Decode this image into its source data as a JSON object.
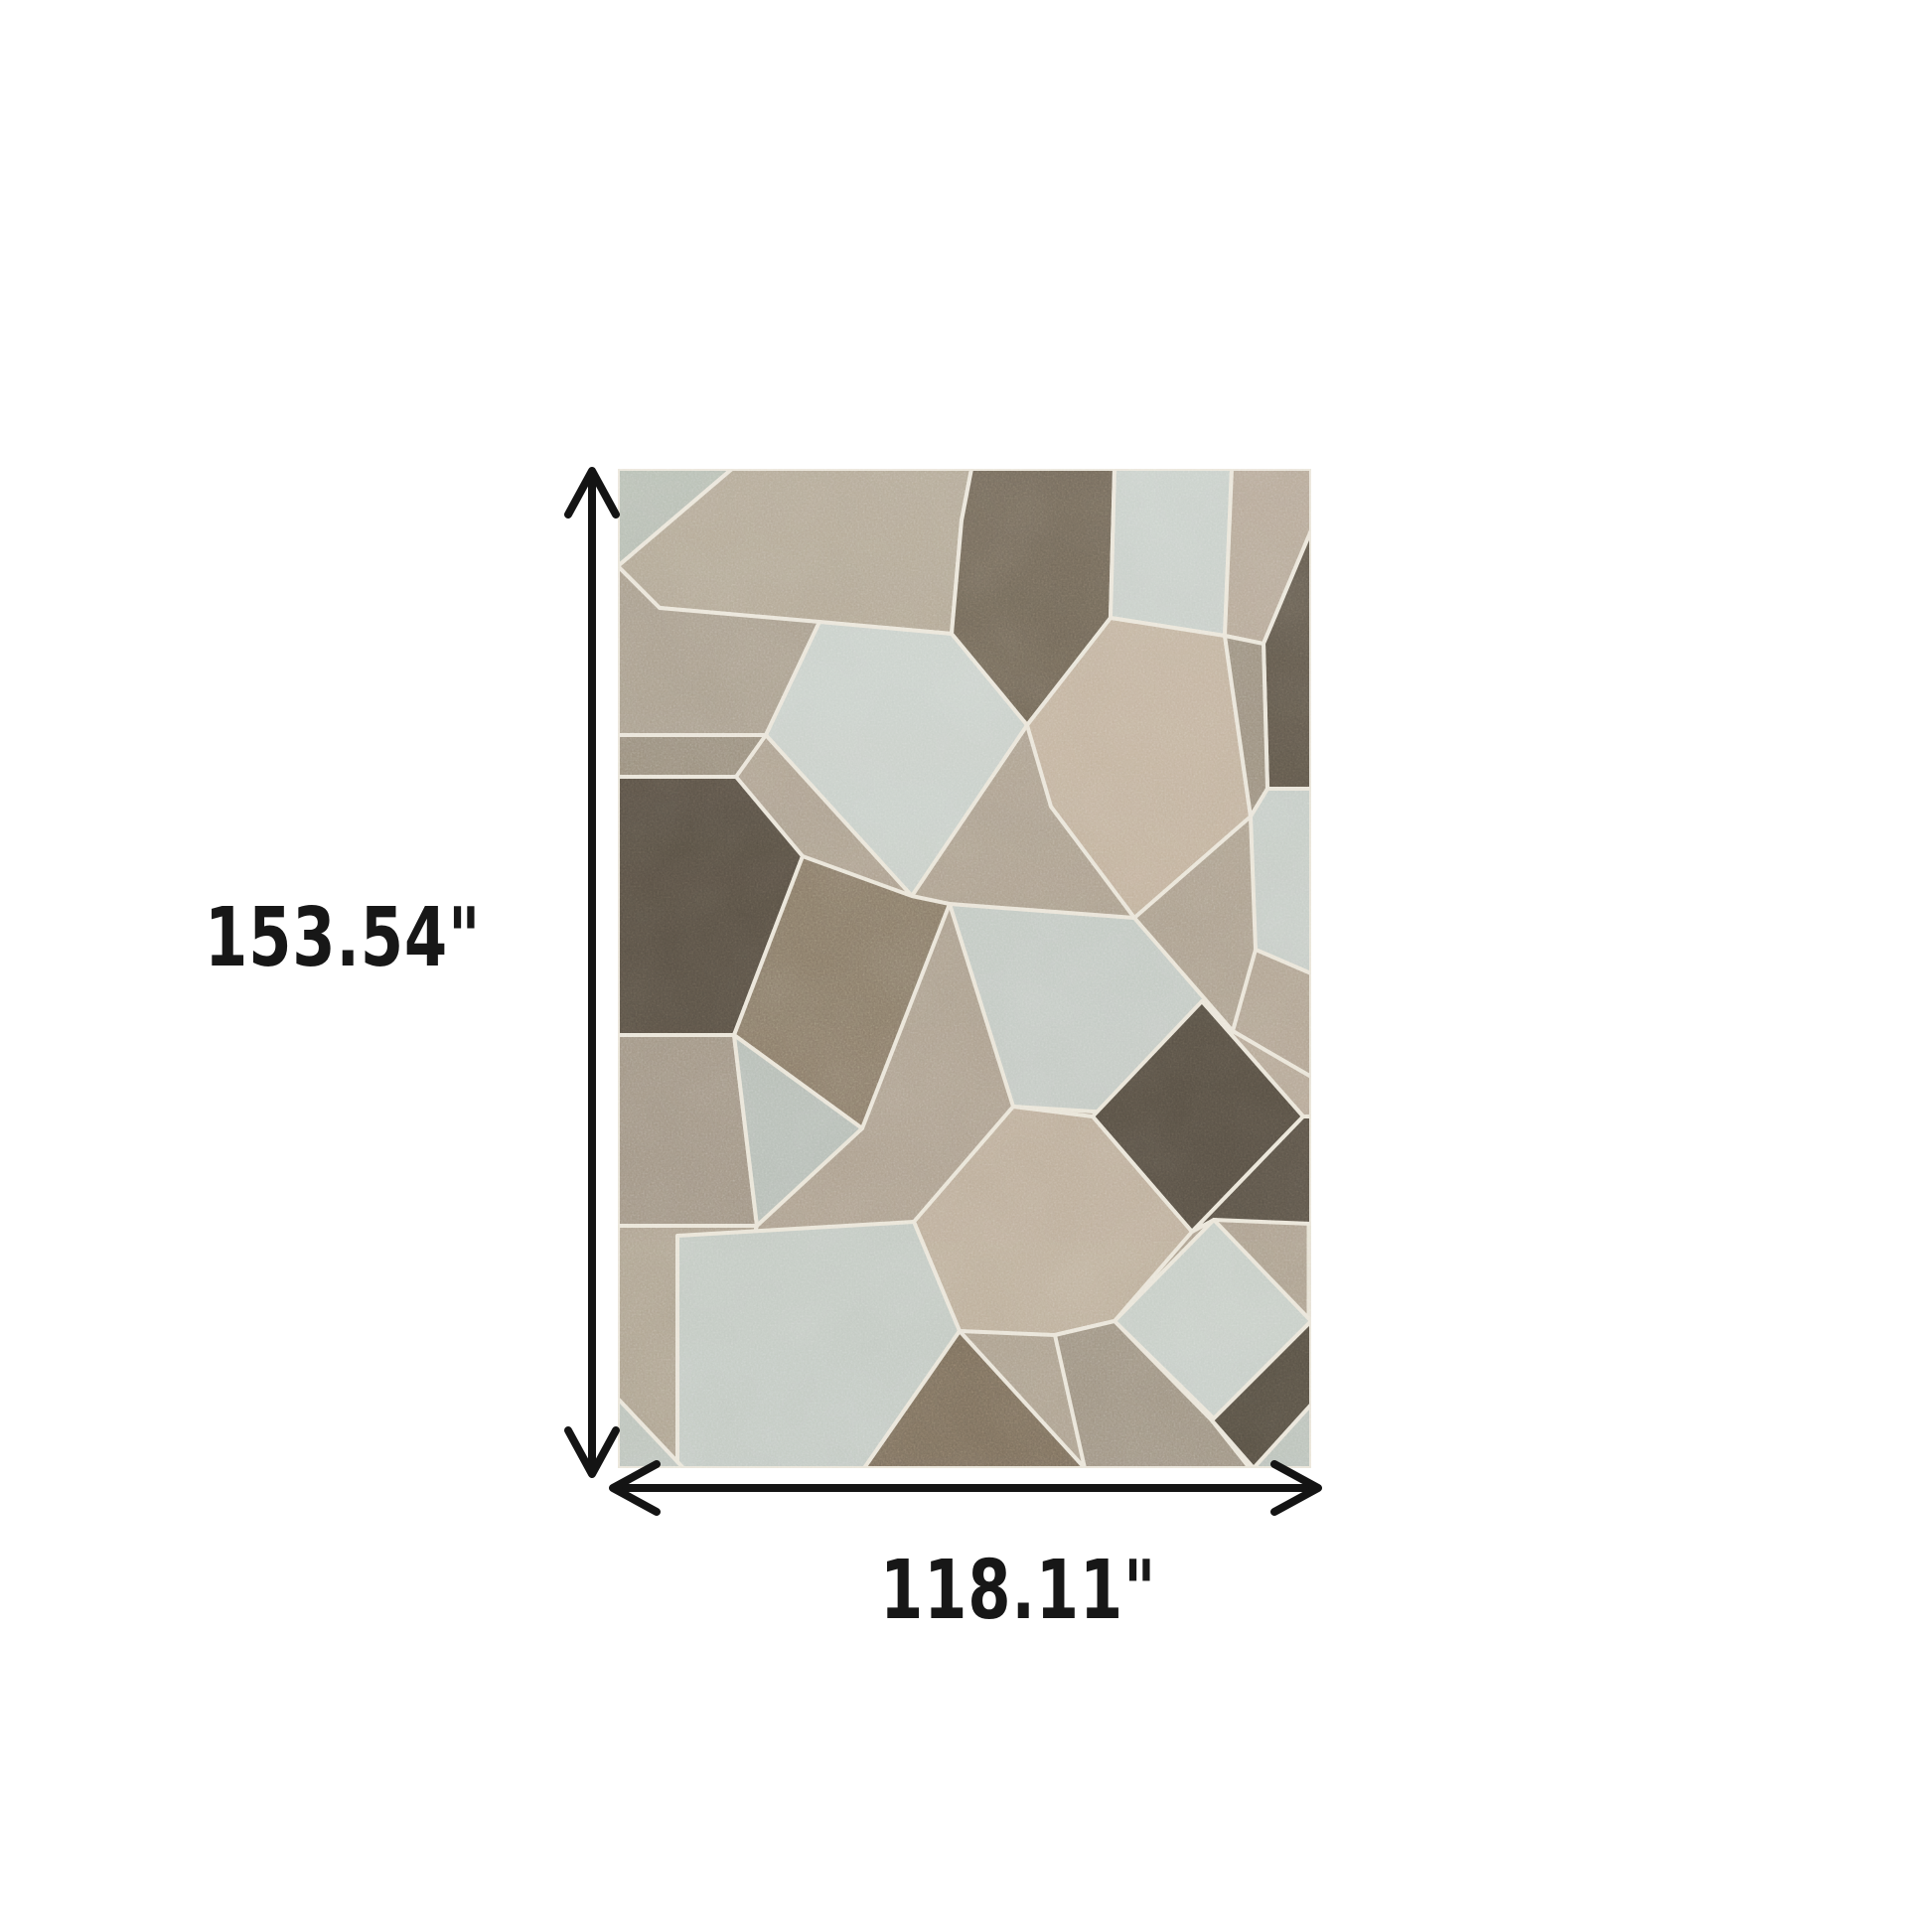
{
  "figure": {
    "title": "Rug dimensions diagram",
    "background_color": "#ffffff"
  },
  "dimensions": {
    "height_label": "153.54\"",
    "width_label": "118.11\"",
    "unit": "inches"
  },
  "annotation": {
    "arrow_color": "#141414",
    "label_color": "#171717",
    "arrow_style": "double-headed chevron"
  },
  "rug": {
    "description": "Rectangular area rug with an abstract geometric patchwork of diamonds, hexagons, trapezoids and triangles in grey, brown, beige and pale blue tones, separated by thin cream lines",
    "palette": {
      "cream_line": "#e9e4d8",
      "pale_blue_grey": "#c6cdc7",
      "sage_green_grey": "#b4bbb0",
      "light_taupe": "#b0a592",
      "beige": "#c1b19d",
      "greige_base": "#aca08f",
      "grey": "#a79c8b",
      "medium_brown": "#897b69",
      "dark_brown": "#5f574b",
      "charcoal_brown": "#564f44"
    }
  }
}
